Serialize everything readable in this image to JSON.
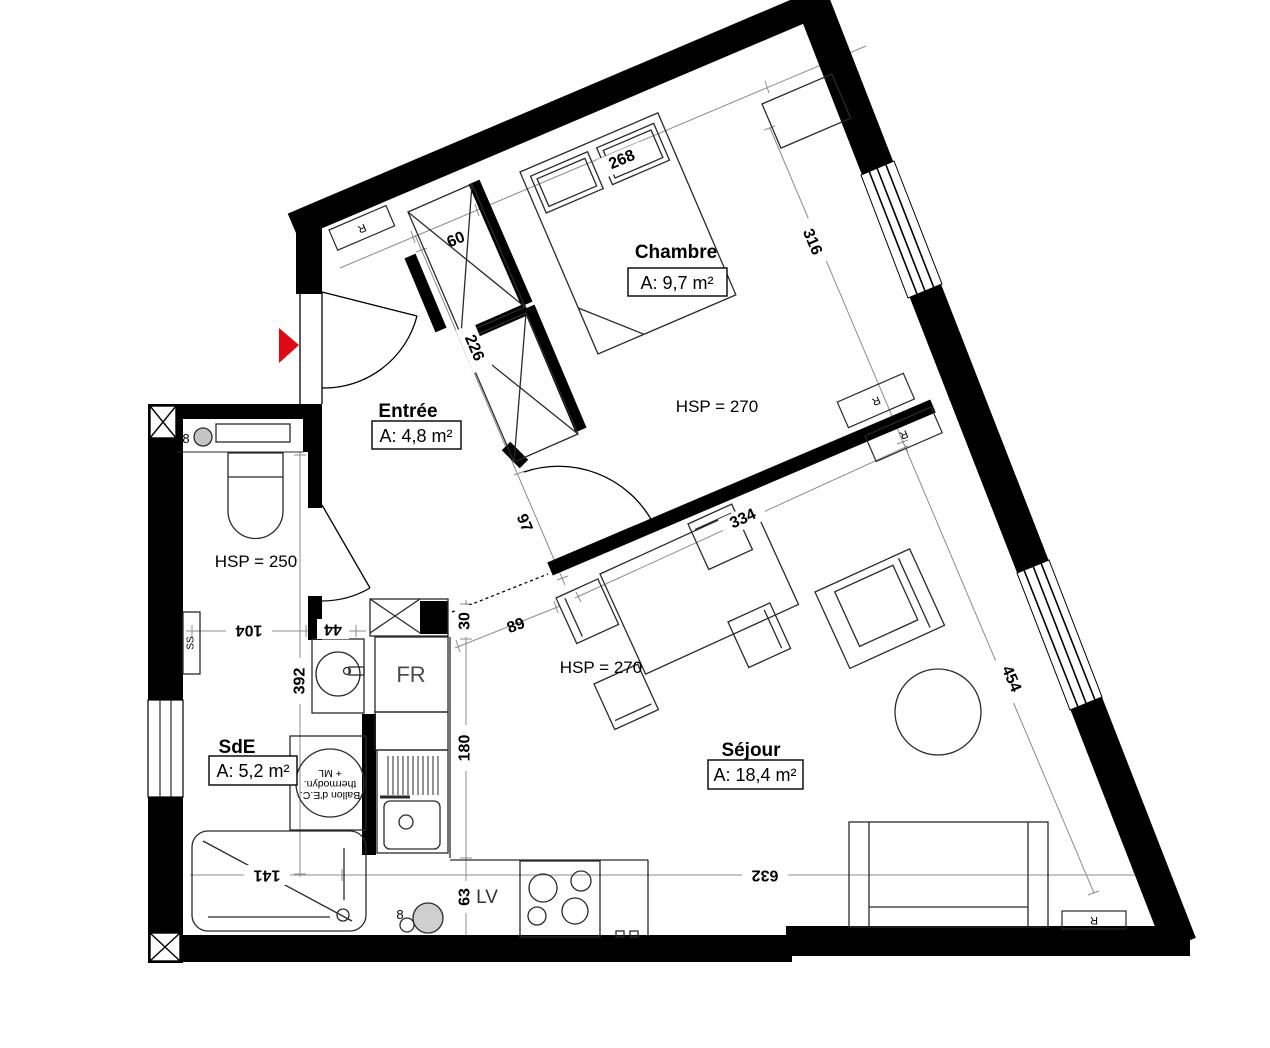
{
  "plan": {
    "rooms": {
      "chambre": {
        "name": "Chambre",
        "area": "A: 9,7 m²",
        "hsp": "HSP = 270"
      },
      "entree": {
        "name": "Entrée",
        "area": "A: 4,8 m²"
      },
      "sde": {
        "name": "SdE",
        "area": "A: 5,2 m²",
        "hsp": "HSP = 250"
      },
      "sejour": {
        "name": "Séjour",
        "area": "A: 18,4 m²",
        "hsp": "HSP = 270"
      }
    },
    "dims": {
      "bed_wall": "268",
      "closet_width": "60",
      "chambre_right": "316",
      "entry_depth": "226",
      "hall": "97",
      "gap": "30",
      "worktop": "89",
      "kitchen_run": "180",
      "kitchen_end": "63",
      "sde_width": "104",
      "vanity": "44",
      "sde_length": "392",
      "shower_width": "141",
      "sejour_width": "632",
      "sejour_wall": "334",
      "sejour_right": "454"
    },
    "labels": {
      "radiator": "R",
      "towel_rail": "SS",
      "fridge": "FR",
      "dishwasher": "LV",
      "pipe": "8",
      "heater_line1": "Ballon d'E.C.",
      "heater_line2": "thermodyn.",
      "heater_line3": "+ ML"
    },
    "colors": {
      "wall": "#000000",
      "entry_arrow": "#e30613",
      "dim_line": "#8c8c8c"
    }
  }
}
